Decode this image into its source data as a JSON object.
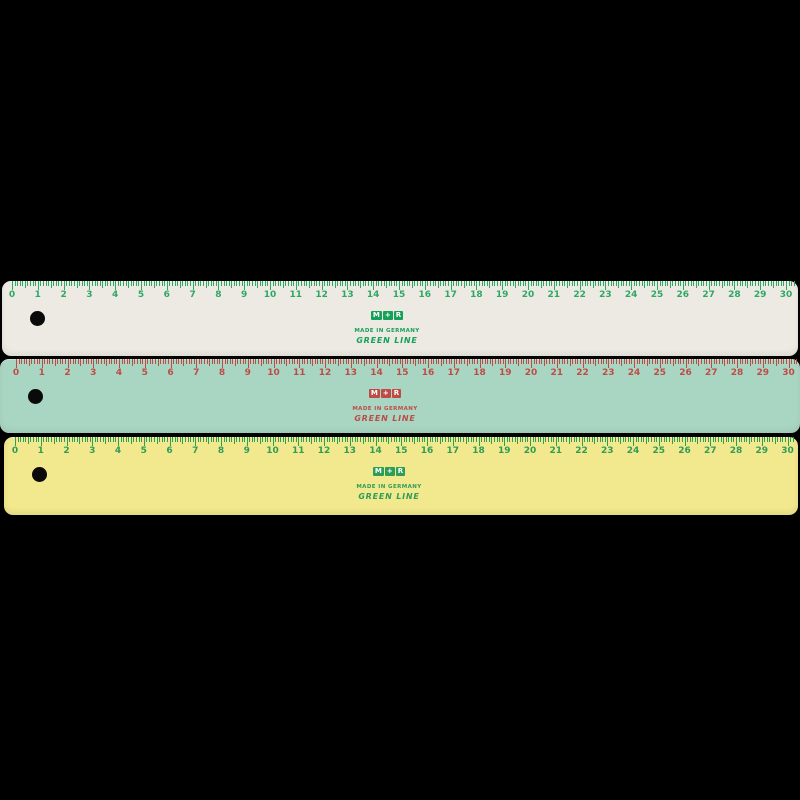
{
  "background_color": "#000000",
  "rulers": [
    {
      "name": "cream-ruler",
      "body_color": "#edeae3",
      "marking_color": "#2ea865",
      "logo_color": "#17a05a",
      "hole_color": "#0a0a0a",
      "brand_letters": [
        "M",
        "+",
        "R"
      ],
      "made_in": "MADE IN GERMANY",
      "line_label": "GREEN LINE",
      "length_cm": 30,
      "ticks_per_cm": 10,
      "unit_numbers": [
        0,
        1,
        2,
        3,
        4,
        5,
        6,
        7,
        8,
        9,
        10,
        11,
        12,
        13,
        14,
        15,
        16,
        17,
        18,
        19,
        20,
        21,
        22,
        23,
        24,
        25,
        26,
        27,
        28,
        29,
        30
      ]
    },
    {
      "name": "mint-ruler",
      "body_color": "#a9d6c2",
      "marking_color": "#bf4b46",
      "logo_color": "#bf4b46",
      "hole_color": "#0a0a0a",
      "brand_letters": [
        "M",
        "+",
        "R"
      ],
      "made_in": "MADE IN GERMANY",
      "line_label": "GREEN LINE",
      "length_cm": 30,
      "ticks_per_cm": 10,
      "unit_numbers": [
        0,
        1,
        2,
        3,
        4,
        5,
        6,
        7,
        8,
        9,
        10,
        11,
        12,
        13,
        14,
        15,
        16,
        17,
        18,
        19,
        20,
        21,
        22,
        23,
        24,
        25,
        26,
        27,
        28,
        29,
        30
      ]
    },
    {
      "name": "yellow-ruler",
      "body_color": "#f2e88d",
      "marking_color": "#2d9e58",
      "logo_color": "#2d9e58",
      "hole_color": "#0a0a0a",
      "brand_letters": [
        "M",
        "+",
        "R"
      ],
      "made_in": "MADE IN GERMANY",
      "line_label": "GREEN LINE",
      "length_cm": 30,
      "ticks_per_cm": 10,
      "unit_numbers": [
        0,
        1,
        2,
        3,
        4,
        5,
        6,
        7,
        8,
        9,
        10,
        11,
        12,
        13,
        14,
        15,
        16,
        17,
        18,
        19,
        20,
        21,
        22,
        23,
        24,
        25,
        26,
        27,
        28,
        29,
        30
      ]
    }
  ]
}
